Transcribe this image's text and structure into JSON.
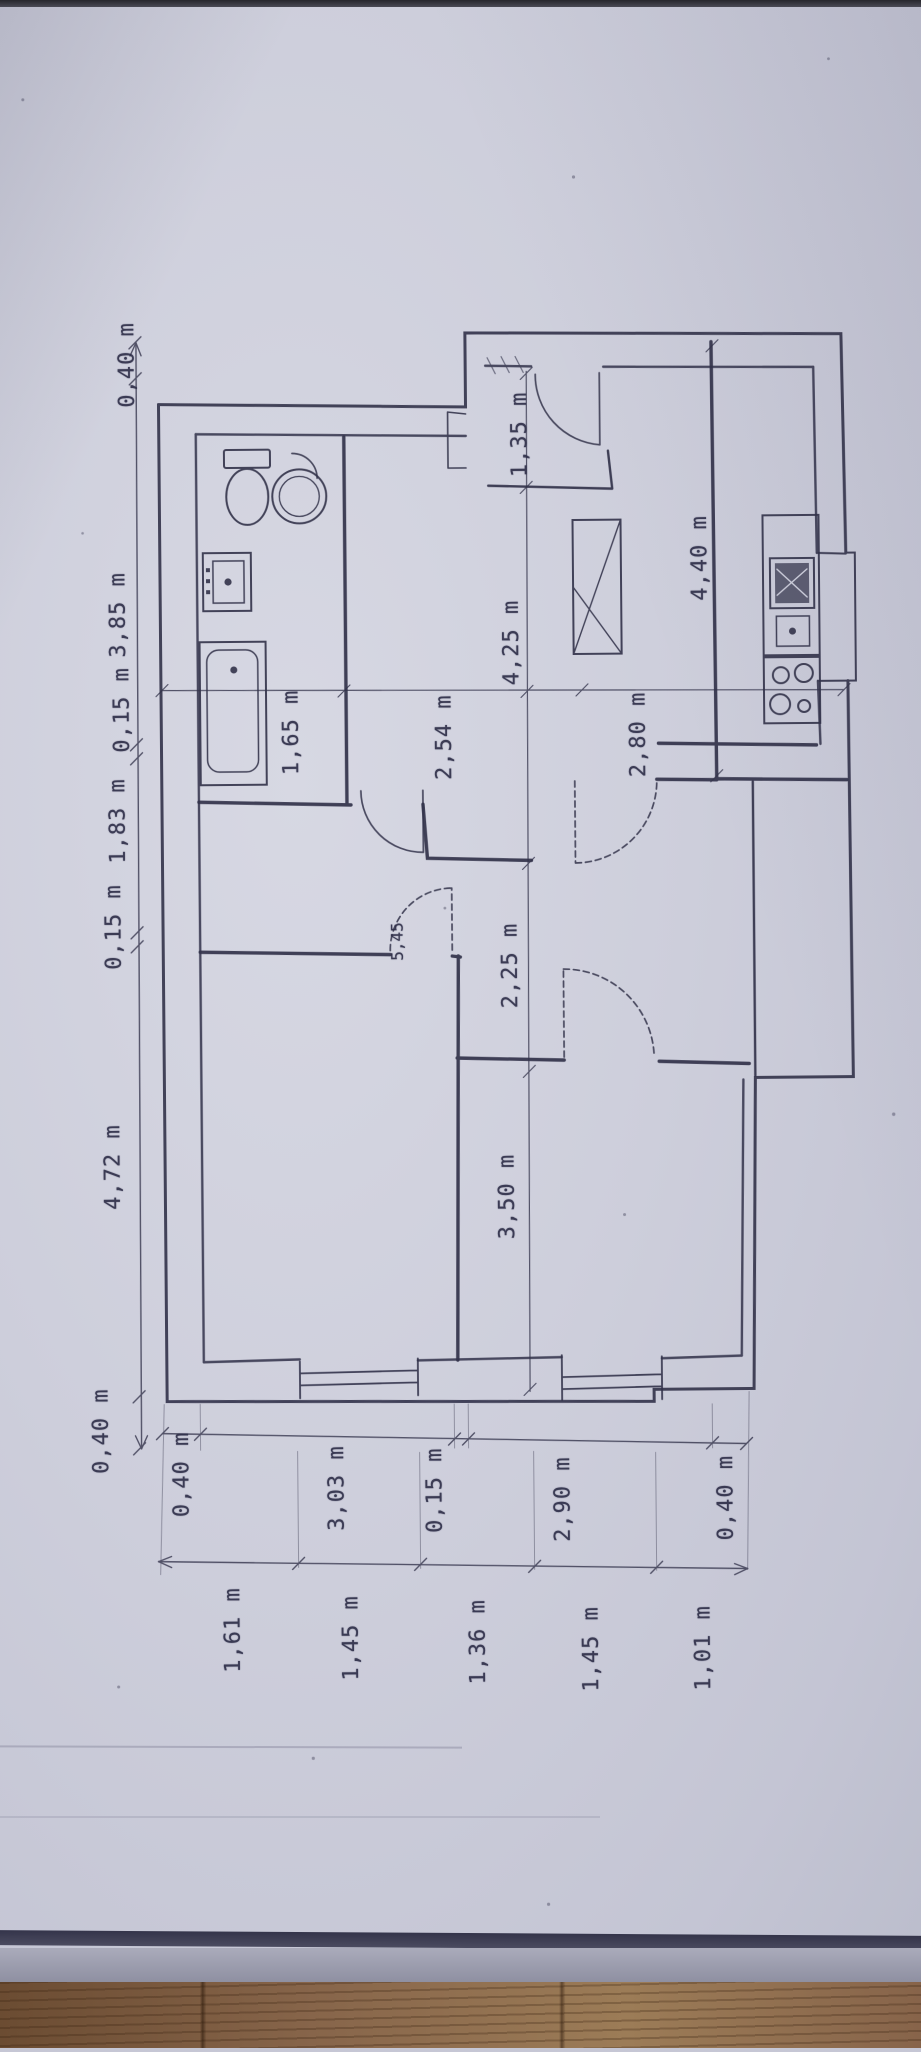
{
  "photo": {
    "paper_color": "#cdcedb",
    "ink_color": "#32324a",
    "wood_color": "#87654a"
  },
  "plan": {
    "left_chain": [
      "0,40 m",
      "3,85 m",
      "0,15 m",
      "1,83 m",
      "0,15 m",
      "4,72 m",
      "0,40 m"
    ],
    "bottom_chain_inner": [
      "0,40 m",
      "3,03 m",
      "0,15 m",
      "2,90 m",
      "0,40 m"
    ],
    "bottom_chain_outer": [
      "1,61 m",
      "1,45 m",
      "1,36 m",
      "1,45 m",
      "1,01 m"
    ],
    "interior_dimensions": [
      "1,65 m",
      "2,54 m",
      "2,80 m",
      "4,25 m",
      "1,35 m",
      "4,40 m",
      "2,25 m",
      "3,50 m",
      "5,45"
    ]
  }
}
